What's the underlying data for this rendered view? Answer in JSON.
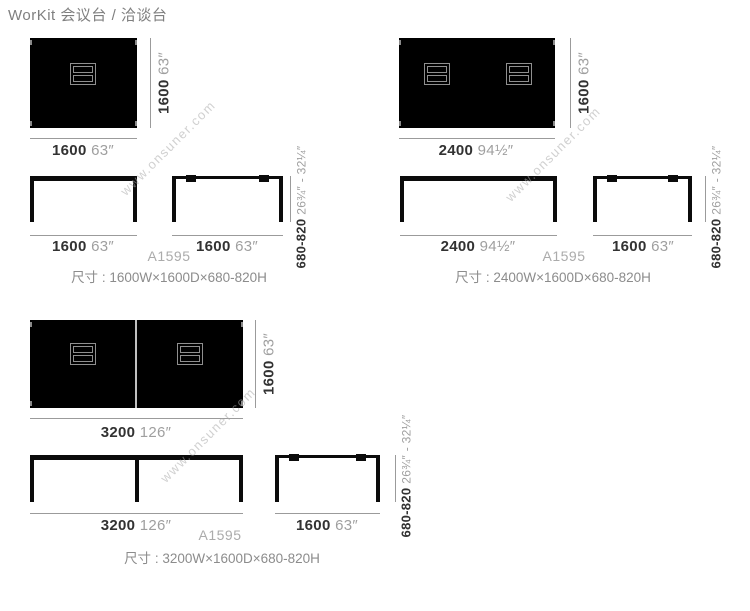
{
  "page": {
    "title": "WorKit 会议台 / 洽谈台",
    "watermark": "www.onsuner.com"
  },
  "groups": [
    {
      "name": "1600 x 1600 table",
      "plan_width": {
        "mm": "1600",
        "inch": "63″"
      },
      "plan_depth": {
        "mm": "1600",
        "inch": "63″"
      },
      "front_wide": {
        "mm": "1600",
        "inch": "63″"
      },
      "front_side": {
        "mm": "1600",
        "inch": "63″"
      },
      "height": {
        "mm": "680-820",
        "inch": "26¾″ - 32¼″"
      },
      "model": "A1595",
      "size_text": "尺寸 : 1600W×1600D×680-820H"
    },
    {
      "name": "2400 x 1600 table",
      "plan_width": {
        "mm": "2400",
        "inch": "94½″"
      },
      "plan_depth": {
        "mm": "1600",
        "inch": "63″"
      },
      "front_wide": {
        "mm": "2400",
        "inch": "94½″"
      },
      "front_side": {
        "mm": "1600",
        "inch": "63″"
      },
      "height": {
        "mm": "680-820",
        "inch": "26¾″ - 32¼″"
      },
      "model": "A1595",
      "size_text": "尺寸 : 2400W×1600D×680-820H"
    },
    {
      "name": "3200 x 1600 table",
      "plan_width": {
        "mm": "3200",
        "inch": "126″"
      },
      "plan_depth": {
        "mm": "1600",
        "inch": "63″"
      },
      "front_wide": {
        "mm": "3200",
        "inch": "126″"
      },
      "front_side": {
        "mm": "1600",
        "inch": "63″"
      },
      "height": {
        "mm": "680-820",
        "inch": "26¾″ - 32¼″"
      },
      "model": "A1595",
      "size_text": "尺寸 : 3200W×1600D×680-820H"
    }
  ]
}
